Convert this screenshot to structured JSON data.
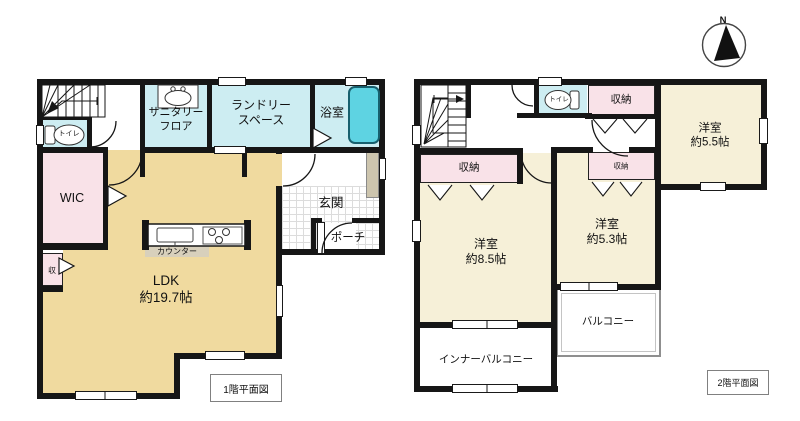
{
  "compass": {
    "north_label": "N"
  },
  "floor1": {
    "caption": "1階平面図",
    "labels": {
      "toilet": "トイレ",
      "sanitary1": "サニタリー",
      "sanitary2": "フロア",
      "laundry1": "ランドリー",
      "laundry2": "スペース",
      "bath": "浴室",
      "wic": "WIC",
      "closet": "収",
      "counter": "カウンター",
      "ldk1": "LDK",
      "ldk2": "約19.7帖",
      "entrance": "玄関",
      "porch": "ポーチ"
    }
  },
  "floor2": {
    "caption": "2階平面図",
    "labels": {
      "toilet": "トイレ",
      "storage_top": "収納",
      "storage_left": "収納",
      "storage_small": "収納",
      "room55_1": "洋室",
      "room55_2": "約5.5帖",
      "room85_1": "洋室",
      "room85_2": "約8.5帖",
      "room53_1": "洋室",
      "room53_2": "約5.3帖",
      "balcony": "バルコニー",
      "inner_balcony": "インナーバルコニー"
    }
  },
  "colors": {
    "wall": "#161616",
    "water_rooms": "#cdedf2",
    "bathtub": "#5ed3e2",
    "storage_pink": "#f9e2e8",
    "ldk_tan": "#f0da9f",
    "bedroom_cream": "#f6f0d8"
  }
}
